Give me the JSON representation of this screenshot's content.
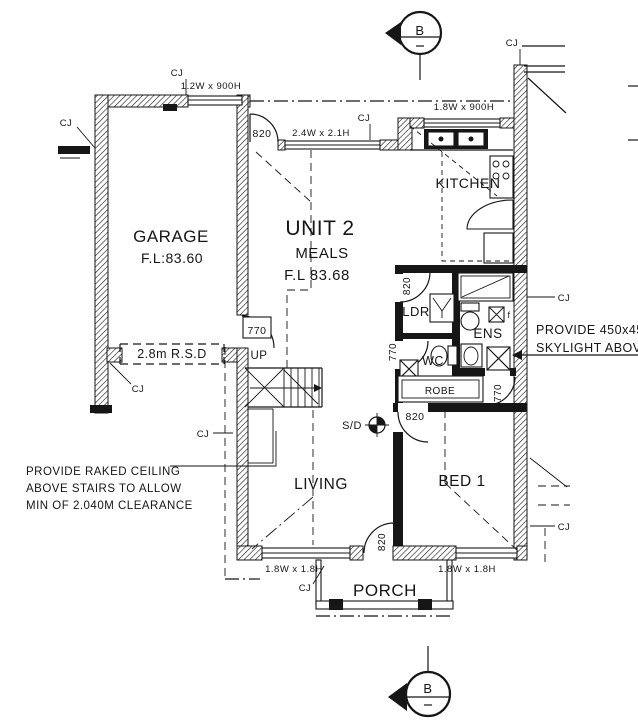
{
  "drawing": {
    "rooms": {
      "unit_title": "UNIT 2",
      "meals": "MEALS",
      "meals_fl": "F.L 83.68",
      "garage": "GARAGE",
      "garage_fl": "F.L:83.60",
      "kitchen": "KITCHEN",
      "living": "LIVING",
      "bed1": "BED 1",
      "porch": "PORCH",
      "laundry": "LDR",
      "ensuite": "ENS",
      "wc": "WC",
      "robe": "ROBE"
    },
    "windows": {
      "garage_top": "1.2W x 900H",
      "meals_top": "2.4W x 2.1H",
      "kitchen_top": "1.8W x 900H",
      "living_front": "1.8W x 1.8H",
      "bed1_front": "1.8W x 1.8H"
    },
    "doors": {
      "w820": "820",
      "w770": "770"
    },
    "labels": {
      "up": "UP",
      "smoke_detector": "S/D",
      "roller_door": "2.8m R.S.D",
      "control_joint": "CJ",
      "fan": "f",
      "section_mark": "B"
    },
    "notes": {
      "skylight_1": "PROVIDE 450x450",
      "skylight_2": "SKYLIGHT ABOVE",
      "raked_1": "PROVIDE RAKED CEILING",
      "raked_2": "ABOVE STAIRS TO ALLOW",
      "raked_3": "MIN OF 2.040M CLEARANCE"
    },
    "colors": {
      "ink": "#161616",
      "paper": "#ffffff"
    }
  }
}
